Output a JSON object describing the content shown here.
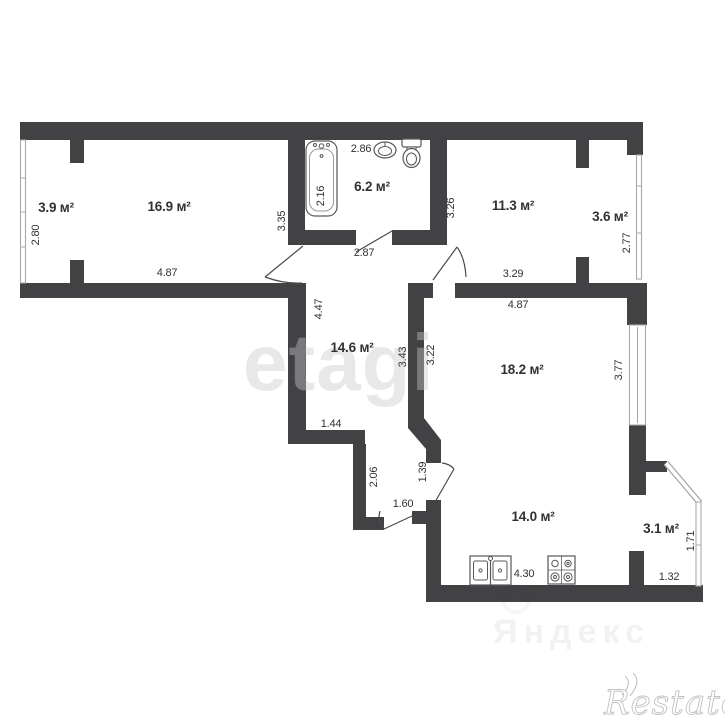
{
  "plan": {
    "rooms": {
      "balcony_left": {
        "area": "3.9 м²",
        "dims": {
          "height": "2.80"
        }
      },
      "living_room": {
        "area": "16.9 м²",
        "dims": {
          "width": "4.87"
        }
      },
      "bathroom": {
        "area": "6.2 м²",
        "dims": {
          "bathtub": "2.16",
          "top": "2.86",
          "left": "3.35",
          "right": "3.26",
          "door": "2.87"
        }
      },
      "bedroom": {
        "area": "11.3 м²",
        "dims": {
          "width": "3.29"
        }
      },
      "balcony_right": {
        "area": "3.6 м²",
        "dims": {
          "height": "2.77"
        }
      },
      "hallway": {
        "area": "14.6 м²",
        "dims": {
          "left": "4.47",
          "right_upper": "3.43",
          "right_lower": "3.22",
          "step": "1.44",
          "lower": "2.06",
          "entrance_door": "1.60"
        }
      },
      "living_kitchen": {
        "area": "18.2 м²",
        "dims": {
          "width": "4.87",
          "height": "3.77"
        }
      },
      "kitchen": {
        "area": "14.0 м²",
        "dims": {
          "width": "4.30",
          "door": "1.39"
        }
      },
      "balcony_bottom": {
        "area": "3.1 м²",
        "dims": {
          "height": "1.71",
          "width": "1.32"
        }
      }
    },
    "watermarks": {
      "center": "etagi",
      "ghost": "Яндекс",
      "bottom_right": "Restate"
    }
  },
  "colors": {
    "wall": "#424245",
    "dim_text": "#323234",
    "window": "#a8a8aa",
    "watermark": "#c9c9c9"
  }
}
